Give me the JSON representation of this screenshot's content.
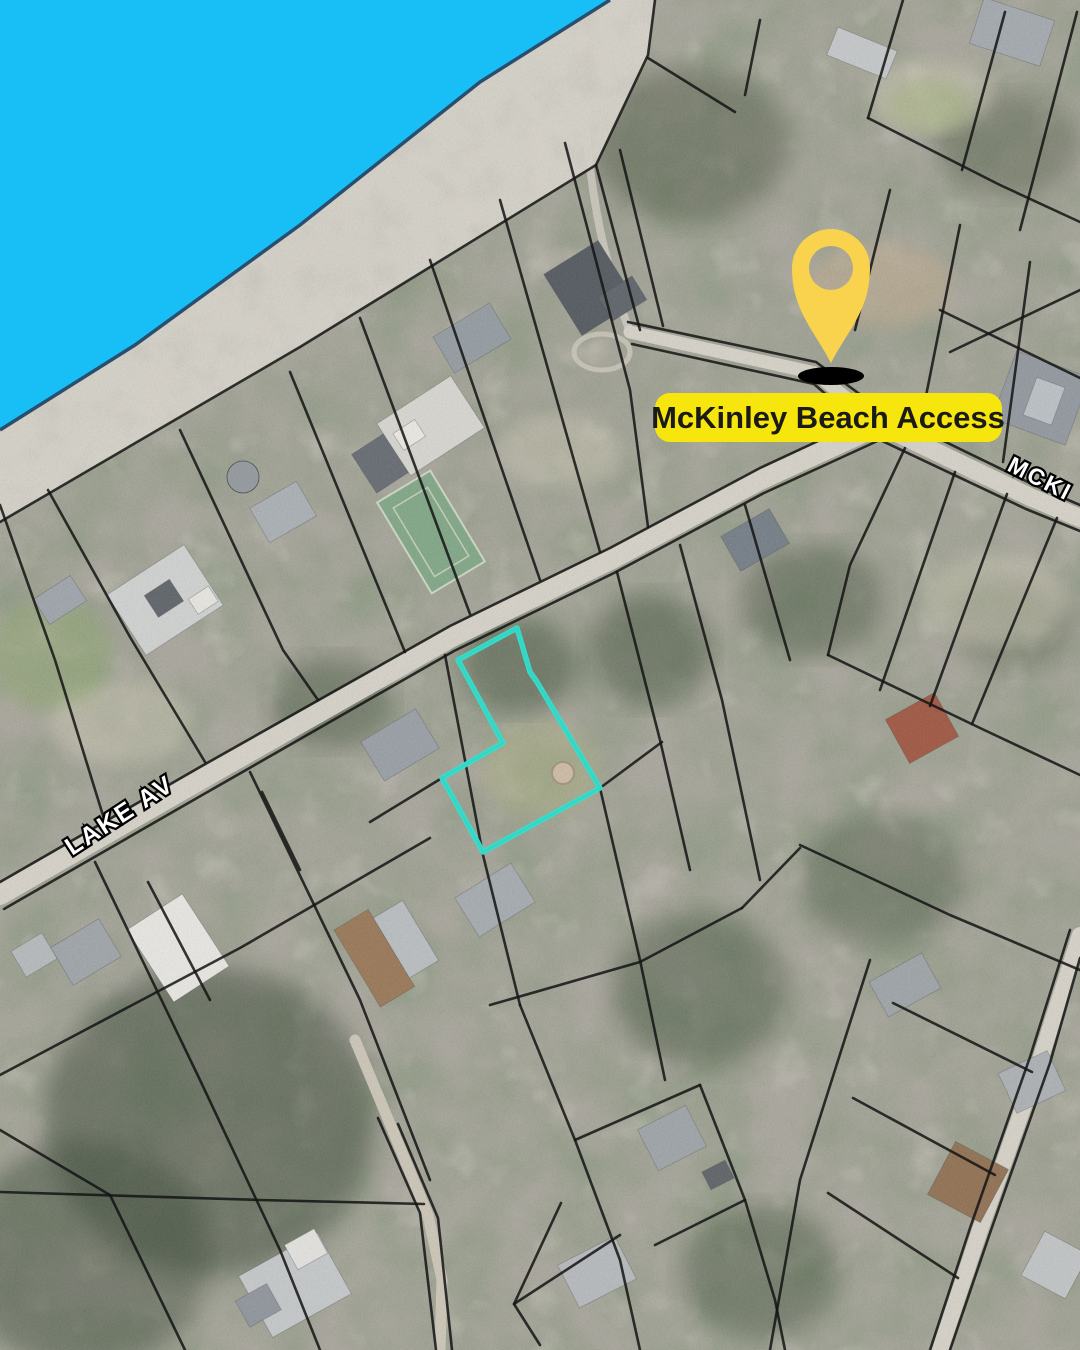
{
  "map": {
    "annotation_pin": {
      "label": "McKinley Beach Access",
      "pin_color": "#F9D34E",
      "pin_shadow_color": "#000000",
      "label_bg_color": "#F7E60D",
      "label_text_color": "#1A1A18"
    },
    "highlighted_parcel": {
      "outline_color": "#35DFCE",
      "points": "517,628 530,672 537,682 600,788 483,852 442,778 503,743 458,660"
    },
    "street_labels": [
      {
        "text": "LAKE AV"
      },
      {
        "text": "MCKI"
      }
    ],
    "water_color": "#18BFF7",
    "shoreline_color": "#2A4F6E"
  }
}
